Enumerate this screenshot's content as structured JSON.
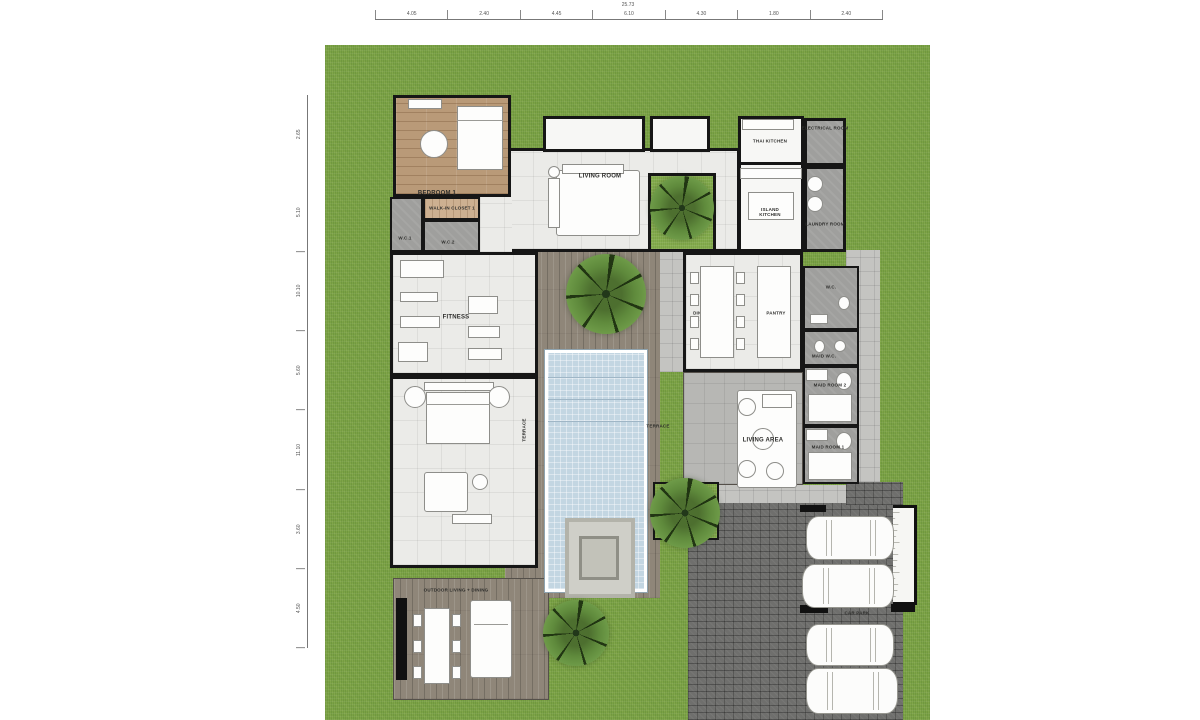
{
  "plan": {
    "rooms": {
      "bedroom1": "BEDROOM 1",
      "walk_in_closet": "WALK-IN CLOSET 1",
      "wc1": "W.C.1",
      "wc2": "W.C.2",
      "living_room": "LIVING ROOM",
      "thai_kitchen": "THAI KITCHEN",
      "electrical_room": "ELECTRICAL ROOM",
      "island_kitchen": "ISLAND\nKITCHEN",
      "laundry_room": "LAUNDRY ROOM",
      "fitness": "FITNESS",
      "dining_room": "DINING RM",
      "pantry": "PANTRY",
      "wc": "W.C.",
      "maid_wc": "MAID W.C.",
      "maid_room2": "MAID ROOM 2",
      "maid_room1": "MAID ROOM 1",
      "living_area": "LIVING AREA",
      "terrace_west": "TERRACE",
      "terrace_east": "TERRACE",
      "outdoor_living_dining": "OUTDOOR LIVING + DINING",
      "car_park": "CAR PARK"
    },
    "dimensions": {
      "top_total": "25.73",
      "top_segments": [
        "4.05",
        "2.40",
        "4.45",
        "6.10",
        "4.30",
        "1.80",
        "2.40"
      ],
      "left_segments": [
        "2.65",
        "5.10",
        "10.10",
        "5.60",
        "11.10",
        "3.60",
        "4.50"
      ]
    },
    "colors": {
      "grass": "#7ba245",
      "deck_wood": "#8f8679",
      "pool_water": "#c3d6e2",
      "cobblestone": "#6f6f6d",
      "interior_tile": "#ebebe8",
      "wall": "#161616"
    }
  }
}
